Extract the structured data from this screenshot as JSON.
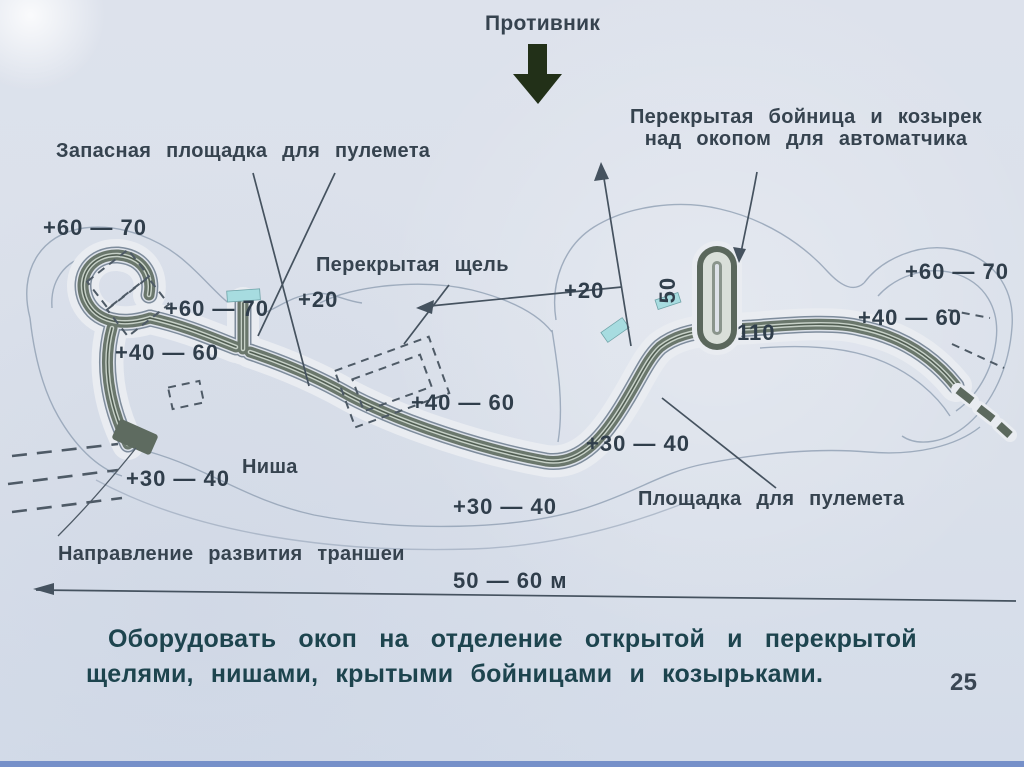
{
  "slide": {
    "page_number": "25",
    "caption_line1": "Оборудовать окоп на отделение открытой и перекрытой",
    "caption_line2": "щелями, нишами, крытыми бойницами и козырьками."
  },
  "diagram": {
    "enemy_label": "Противник",
    "labels": {
      "reserve_mg_platform": "Запасная площадка для пулемета",
      "covered_embrasure_line1": "Перекрытая бойница и козырек",
      "covered_embrasure_line2": "над окопом для автоматчика",
      "covered_slit": "Перекрытая щель",
      "niche": "Ниша",
      "mg_platform": "Площадка для пулемета",
      "trench_direction": "Направление развития траншеи"
    },
    "annotations": {
      "front_width": "50 — 60 м",
      "depth_marks": [
        {
          "id": "left-top",
          "text": "+60 — 70"
        },
        {
          "id": "left-mid",
          "text": "+60 — 70"
        },
        {
          "id": "left-lower",
          "text": "+40 — 60"
        },
        {
          "id": "center-left",
          "text": "+20"
        },
        {
          "id": "center-right",
          "text": "+20"
        },
        {
          "id": "spur-width",
          "text": "50"
        },
        {
          "id": "spur-length",
          "text": "110"
        },
        {
          "id": "right-top",
          "text": "+60 — 70"
        },
        {
          "id": "right-mid",
          "text": "+40 — 60"
        },
        {
          "id": "center",
          "text": "+40 — 60"
        },
        {
          "id": "bottom-left",
          "text": "+30 — 40"
        },
        {
          "id": "bottom-center",
          "text": "+30 — 40"
        },
        {
          "id": "bottom-right",
          "text": "+30 — 40"
        }
      ]
    },
    "colors": {
      "paper": "#dae0ea",
      "ink": "#36434f",
      "caption_ink": "#1d444e",
      "trench_dark": "#6a776c",
      "trench_light": "#c6d0c7",
      "berm_outline": "#94a3b6",
      "cyan_highlight": "#a7dce0",
      "enemy_arrow": "#223018",
      "slide_border_blue": "#7690c9"
    }
  }
}
